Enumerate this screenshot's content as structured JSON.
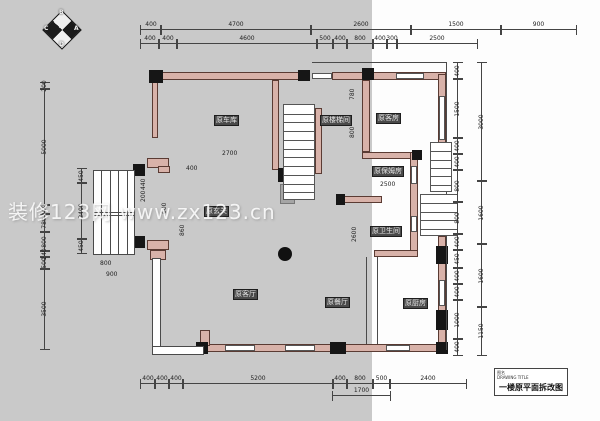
{
  "background": {
    "panel_color": "#c9c9c9",
    "split_x": 372
  },
  "watermark": {
    "text": "装修123网 www.zx123.cn"
  },
  "compass": {
    "letters": {
      "n": "B",
      "e": "A",
      "s": "D",
      "w": "C"
    }
  },
  "title_block": {
    "label": "图名",
    "sublabel": "DRAWING TITLE",
    "title": "一楼原平面拆改图"
  },
  "rooms": [
    {
      "id": "garage",
      "label": "原车库",
      "x": 214,
      "y": 115
    },
    {
      "id": "stairwell",
      "label": "原楼梯间",
      "x": 320,
      "y": 115
    },
    {
      "id": "guest-room",
      "label": "原客房",
      "x": 376,
      "y": 113
    },
    {
      "id": "entry",
      "label": "原玄关",
      "x": 204,
      "y": 206
    },
    {
      "id": "nanny-room",
      "label": "原保姆房",
      "x": 372,
      "y": 166
    },
    {
      "id": "bathroom",
      "label": "原卫生间",
      "x": 370,
      "y": 226
    },
    {
      "id": "living-room",
      "label": "原客厅",
      "x": 233,
      "y": 289
    },
    {
      "id": "dining-room",
      "label": "原餐厅",
      "x": 325,
      "y": 297
    },
    {
      "id": "kitchen",
      "label": "原厨房",
      "x": 403,
      "y": 298
    }
  ],
  "dim_chains": [
    {
      "id": "top-outer",
      "orient": "h",
      "x": 140,
      "y": 30,
      "segments": [
        {
          "v": "400",
          "w": 20
        },
        {
          "v": "4700",
          "w": 150
        },
        {
          "v": "2600",
          "w": 100
        },
        {
          "v": "1500",
          "w": 90
        },
        {
          "v": "900",
          "w": 75
        }
      ]
    },
    {
      "id": "top-inner",
      "orient": "h",
      "x": 140,
      "y": 44,
      "segments": [
        {
          "v": "400",
          "w": 18
        },
        {
          "v": "400",
          "w": 18
        },
        {
          "v": "4600",
          "w": 140
        },
        {
          "v": "500",
          "w": 16
        },
        {
          "v": "400",
          "w": 14
        },
        {
          "v": "800",
          "w": 26
        },
        {
          "v": "400",
          "w": 14
        },
        {
          "v": "300",
          "w": 10
        },
        {
          "v": "2500",
          "w": 80
        }
      ]
    },
    {
      "id": "bottom",
      "orient": "h",
      "x": 140,
      "y": 384,
      "segments": [
        {
          "v": "400",
          "w": 14
        },
        {
          "v": "400",
          "w": 14
        },
        {
          "v": "400",
          "w": 14
        },
        {
          "v": "5200",
          "w": 150
        },
        {
          "v": "400",
          "w": 14
        },
        {
          "v": "800",
          "w": 26
        },
        {
          "v": "500",
          "w": 17
        },
        {
          "v": "2400",
          "w": 76
        }
      ]
    },
    {
      "id": "bottom-sub",
      "orient": "h",
      "x": 332,
      "y": 396,
      "segments": [
        {
          "v": "1700",
          "w": 57
        }
      ]
    },
    {
      "id": "left-outer",
      "orient": "v",
      "x": 45,
      "y": 82,
      "segments": [
        {
          "v": "200",
          "w": 6
        },
        {
          "v": "5000",
          "w": 116
        },
        {
          "v": "400",
          "w": 9
        },
        {
          "v": "780",
          "w": 18
        },
        {
          "v": "800",
          "w": 19
        },
        {
          "v": "240",
          "w": 6
        },
        {
          "v": "500",
          "w": 12
        },
        {
          "v": "3500",
          "w": 80
        }
      ]
    },
    {
      "id": "left-inner",
      "orient": "v",
      "x": 82,
      "y": 168,
      "segments": [
        {
          "v": "450",
          "w": 14
        },
        {
          "v": "2400",
          "w": 56
        },
        {
          "v": "450",
          "w": 14
        }
      ]
    },
    {
      "id": "right-inner",
      "orient": "v",
      "x": 458,
      "y": 62,
      "segments": [
        {
          "v": "400",
          "w": 16
        },
        {
          "v": "1500",
          "w": 59
        },
        {
          "v": "400",
          "w": 16
        },
        {
          "v": "400",
          "w": 16
        },
        {
          "v": "800",
          "w": 32
        },
        {
          "v": "800",
          "w": 32
        },
        {
          "v": "400",
          "w": 16
        },
        {
          "v": "450",
          "w": 18
        },
        {
          "v": "400",
          "w": 16
        },
        {
          "v": "400",
          "w": 16
        },
        {
          "v": "1000",
          "w": 39
        },
        {
          "v": "400",
          "w": 16
        }
      ]
    },
    {
      "id": "right-outer",
      "orient": "v",
      "x": 482,
      "y": 62,
      "segments": [
        {
          "v": "3000",
          "w": 118
        },
        {
          "v": "1600",
          "w": 63
        },
        {
          "v": "1600",
          "w": 63
        },
        {
          "v": "1150",
          "w": 48
        }
      ]
    }
  ],
  "interior_dims": [
    {
      "t": "2700",
      "x": 222,
      "y": 151,
      "r": 0
    },
    {
      "t": "2500",
      "x": 380,
      "y": 182,
      "r": 0
    },
    {
      "t": "780",
      "x": 350,
      "y": 100,
      "r": 1
    },
    {
      "t": "800",
      "x": 350,
      "y": 138,
      "r": 1
    },
    {
      "t": "800",
      "x": 100,
      "y": 261,
      "r": 0
    },
    {
      "t": "900",
      "x": 106,
      "y": 272,
      "r": 0
    },
    {
      "t": "440",
      "x": 141,
      "y": 190,
      "r": 1
    },
    {
      "t": "200",
      "x": 141,
      "y": 202,
      "r": 1
    },
    {
      "t": "600",
      "x": 162,
      "y": 214,
      "r": 1
    },
    {
      "t": "860",
      "x": 180,
      "y": 236,
      "r": 1
    },
    {
      "t": "400",
      "x": 186,
      "y": 166,
      "r": 0
    },
    {
      "t": "2600",
      "x": 352,
      "y": 242,
      "r": 1
    }
  ],
  "plan": {
    "colors": {
      "wall_fill": "#d8b2a9",
      "wall_edge": "#5a3b33",
      "column": "#161616",
      "line": "#4a4a4a"
    },
    "walls": [
      {
        "x": 152,
        "y": 72,
        "w": 158,
        "h": 8
      },
      {
        "x": 332,
        "y": 72,
        "w": 114,
        "h": 8
      },
      {
        "x": 152,
        "y": 80,
        "w": 6,
        "h": 58
      },
      {
        "x": 272,
        "y": 80,
        "w": 7,
        "h": 90
      },
      {
        "x": 315,
        "y": 108,
        "w": 7,
        "h": 66
      },
      {
        "x": 362,
        "y": 80,
        "w": 8,
        "h": 72
      },
      {
        "x": 362,
        "y": 152,
        "w": 56,
        "h": 7
      },
      {
        "x": 340,
        "y": 196,
        "w": 42,
        "h": 7
      },
      {
        "x": 410,
        "y": 152,
        "w": 8,
        "h": 105
      },
      {
        "x": 374,
        "y": 250,
        "w": 44,
        "h": 7
      },
      {
        "x": 438,
        "y": 74,
        "w": 8,
        "h": 116
      },
      {
        "x": 438,
        "y": 236,
        "w": 8,
        "h": 108
      },
      {
        "x": 200,
        "y": 344,
        "w": 246,
        "h": 8
      },
      {
        "x": 147,
        "y": 158,
        "w": 22,
        "h": 10
      },
      {
        "x": 158,
        "y": 166,
        "w": 12,
        "h": 7
      },
      {
        "x": 147,
        "y": 240,
        "w": 22,
        "h": 10
      },
      {
        "x": 150,
        "y": 250,
        "w": 16,
        "h": 10
      },
      {
        "x": 200,
        "y": 330,
        "w": 10,
        "h": 16
      }
    ],
    "columns": [
      {
        "x": 149,
        "y": 70,
        "w": 14,
        "h": 13
      },
      {
        "x": 298,
        "y": 70,
        "w": 12,
        "h": 11
      },
      {
        "x": 362,
        "y": 68,
        "w": 12,
        "h": 12
      },
      {
        "x": 278,
        "y": 168,
        "w": 12,
        "h": 14
      },
      {
        "x": 133,
        "y": 164,
        "w": 12,
        "h": 12
      },
      {
        "x": 133,
        "y": 236,
        "w": 12,
        "h": 12
      },
      {
        "x": 336,
        "y": 194,
        "w": 9,
        "h": 11
      },
      {
        "x": 412,
        "y": 150,
        "w": 10,
        "h": 10
      },
      {
        "x": 436,
        "y": 246,
        "w": 12,
        "h": 18
      },
      {
        "x": 436,
        "y": 310,
        "w": 12,
        "h": 20
      },
      {
        "x": 330,
        "y": 342,
        "w": 16,
        "h": 12
      },
      {
        "x": 196,
        "y": 342,
        "w": 12,
        "h": 12
      },
      {
        "x": 436,
        "y": 342,
        "w": 12,
        "h": 12
      }
    ],
    "windows": [
      {
        "x": 312,
        "y": 73,
        "w": 20,
        "h": 6
      },
      {
        "x": 396,
        "y": 73,
        "w": 28,
        "h": 6
      },
      {
        "x": 439,
        "y": 96,
        "w": 6,
        "h": 44
      },
      {
        "x": 439,
        "y": 280,
        "w": 6,
        "h": 26
      },
      {
        "x": 411,
        "y": 166,
        "w": 6,
        "h": 18
      },
      {
        "x": 411,
        "y": 216,
        "w": 6,
        "h": 16
      },
      {
        "x": 225,
        "y": 345,
        "w": 30,
        "h": 6
      },
      {
        "x": 285,
        "y": 345,
        "w": 30,
        "h": 6
      },
      {
        "x": 386,
        "y": 345,
        "w": 24,
        "h": 6
      }
    ],
    "thin_rects": [
      {
        "x": 93,
        "y": 170,
        "w": 42,
        "h": 85
      },
      {
        "x": 152,
        "y": 258,
        "w": 9,
        "h": 92
      },
      {
        "x": 152,
        "y": 346,
        "w": 52,
        "h": 9
      }
    ],
    "bay": {
      "x": 93,
      "y": 170,
      "w": 42,
      "h": 85,
      "mullions": 4,
      "mid_y": 42
    },
    "stairs": [
      {
        "x": 283,
        "y": 104,
        "w": 32,
        "h": 96,
        "treads": 11
      },
      {
        "x": 430,
        "y": 142,
        "w": 22,
        "h": 50,
        "treads": 6
      },
      {
        "x": 420,
        "y": 194,
        "w": 38,
        "h": 42,
        "treads": 5
      }
    ],
    "gray_blocks": [
      {
        "x": 280,
        "y": 184,
        "w": 15,
        "h": 20
      }
    ],
    "lines": [
      {
        "x": 366,
        "y": 257,
        "w": 1,
        "h": 87
      },
      {
        "x": 377,
        "y": 257,
        "w": 1,
        "h": 87
      },
      {
        "x": 446,
        "y": 62,
        "w": 1,
        "h": 288
      },
      {
        "x": 312,
        "y": 62,
        "w": 134,
        "h": 1
      }
    ],
    "circle_column": {
      "x": 278,
      "y": 247,
      "d": 14
    }
  }
}
